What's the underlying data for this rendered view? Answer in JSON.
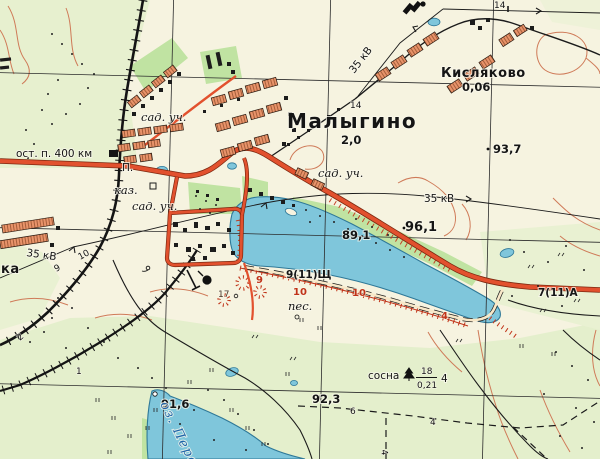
{
  "settlements": {
    "malygino": {
      "name": "Малыгино",
      "capacity": "2,0"
    },
    "kislyakovo": {
      "name": "Кисляково",
      "capacity": "0,06"
    },
    "edge_partial_name": "ка"
  },
  "railway": {
    "halt_label": "ост. п. 400 км",
    "platform_label": "П.",
    "embankment_height": "2",
    "cutting_height": "1"
  },
  "land_labels": {
    "garden_plots": "сад. уч.",
    "barracks": "каз.",
    "sand": "пес."
  },
  "forest": {
    "species": "сосна",
    "height_m": "18",
    "trunk_diameter_m": "0,21",
    "spacing_m": "4"
  },
  "power": {
    "voltage": "35 кВ",
    "pole_height": "14",
    "pole_h9": "9",
    "pole_h10": "10"
  },
  "spot_heights": {
    "h937": "93,7",
    "h961": "96,1",
    "h891": "89,1",
    "h916": "91,6",
    "h923": "92,3"
  },
  "roads": {
    "gravel_spec": "9(11)Щ",
    "asphalt_spec": "7(11)А"
  },
  "water": {
    "lake_name_partial": "оз. Пере"
  },
  "relief_numbers": {
    "n9": "9",
    "n10": "10",
    "n17": "17",
    "n4": "4",
    "n6": "6"
  }
}
